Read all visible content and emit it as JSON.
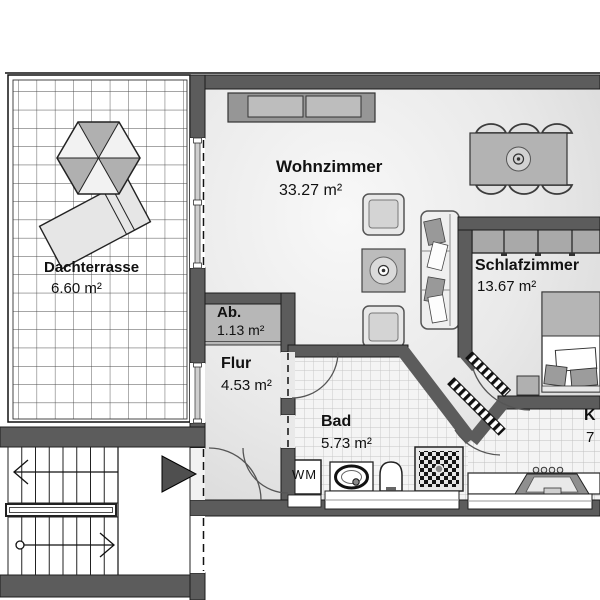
{
  "rooms": {
    "dachterrasse": {
      "name": "Dachterrasse",
      "area": "6.60 m²"
    },
    "wohnzimmer": {
      "name": "Wohnzimmer",
      "area": "33.27 m²"
    },
    "schlafzimmer": {
      "name": "Schlafzimmer",
      "area": "13.67 m²"
    },
    "abstellraum": {
      "name": "Ab.",
      "area": "1.13 m²"
    },
    "flur": {
      "name": "Flur",
      "area": "4.53 m²"
    },
    "bad": {
      "name": "Bad",
      "area": "5.73 m²"
    },
    "kueche": {
      "name_partial": "K",
      "area_partial": "7"
    }
  },
  "labels": {
    "washing_machine": "WM"
  },
  "colors": {
    "wall": "#5c5c5c",
    "floor_light": "#f6f6f6",
    "floor_dark": "#d5d5d5",
    "furniture_gray": "#b5b5b5",
    "tile_floor": "#f4f4f4",
    "entry_arrow": "#4f4f4f"
  }
}
